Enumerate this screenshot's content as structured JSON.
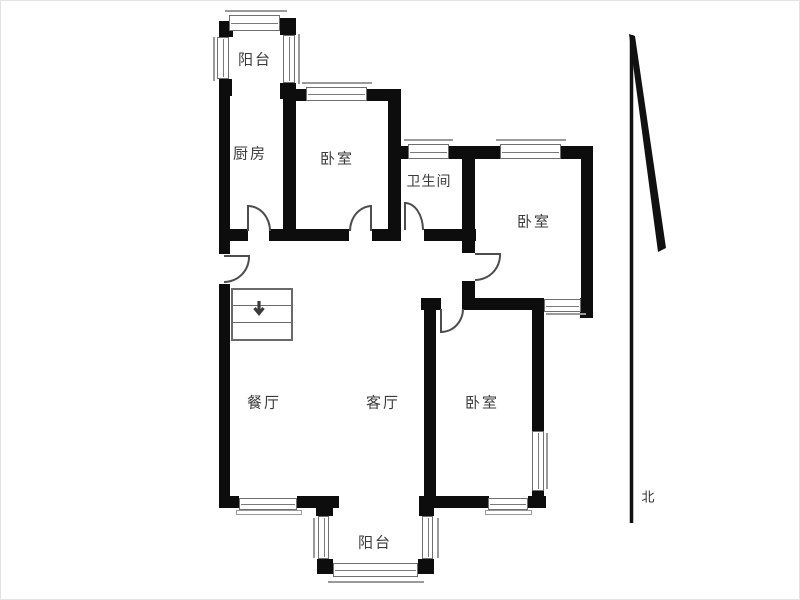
{
  "floorplan": {
    "rooms": [
      {
        "name": "balcony-top",
        "label": "阳台"
      },
      {
        "name": "kitchen",
        "label": "厨房"
      },
      {
        "name": "bedroom-top",
        "label": "卧室"
      },
      {
        "name": "bathroom",
        "label": "卫生间"
      },
      {
        "name": "bedroom-right",
        "label": "卧室"
      },
      {
        "name": "dining-room",
        "label": "餐厅"
      },
      {
        "name": "living-room",
        "label": "客厅"
      },
      {
        "name": "bedroom-bottom",
        "label": "卧室"
      },
      {
        "name": "balcony-bottom",
        "label": "阳台"
      }
    ],
    "compass": {
      "north_label": "北"
    },
    "colors": {
      "wall": "#0d0d0d",
      "window_frame": "#6f6f6f",
      "door_line": "#4d4d4d",
      "text": "#3b3b3b",
      "background": "#ffffff"
    }
  }
}
